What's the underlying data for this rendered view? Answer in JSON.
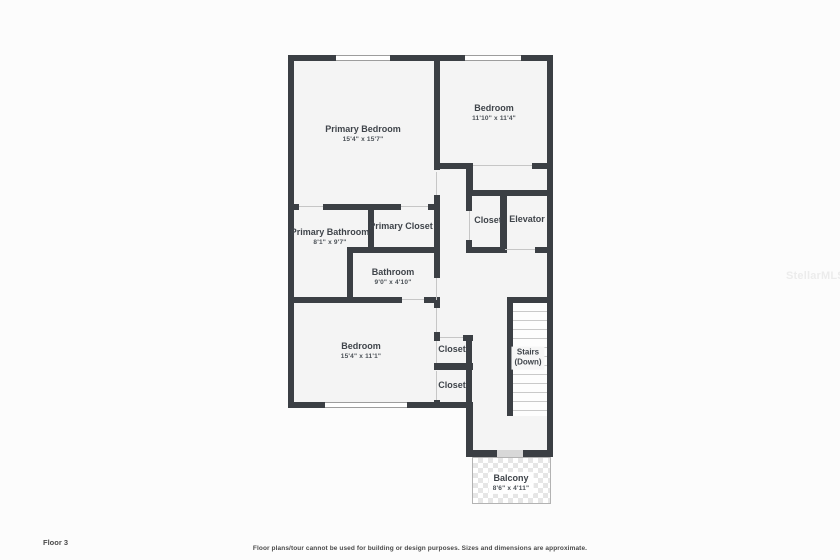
{
  "floor_plan": {
    "rooms": {
      "primary_bedroom": {
        "name": "Primary Bedroom",
        "dims": "15'4\" x 15'7\""
      },
      "bedroom_top": {
        "name": "Bedroom",
        "dims": "11'10\" x 11'4\""
      },
      "closet_mid": {
        "name": "Closet"
      },
      "elevator": {
        "name": "Elevator"
      },
      "primary_bathroom": {
        "name": "Primary Bathroom",
        "dims": "8'1\" x 9'7\""
      },
      "primary_closet": {
        "name": "Primary Closet"
      },
      "bathroom": {
        "name": "Bathroom",
        "dims": "9'0\" x 4'10\""
      },
      "bedroom_bottom": {
        "name": "Bedroom",
        "dims": "15'4\" x 11'1\""
      },
      "closet_upper": {
        "name": "Closet"
      },
      "closet_lower": {
        "name": "Closet"
      },
      "stairs": {
        "name": "Stairs",
        "dims": "(Down)"
      },
      "balcony": {
        "name": "Balcony",
        "dims": "8'6\" x 4'11\""
      }
    },
    "footer": {
      "floor_label": "Floor 3",
      "disclaimer": "Floor plans/tour cannot be used for building or design purposes. Sizes and dimensions are approximate."
    },
    "watermark": "StellarMLS",
    "colors": {
      "wall": "#3b3f44",
      "floor": "#f4f4f4",
      "label_text": "#3f444a"
    }
  }
}
